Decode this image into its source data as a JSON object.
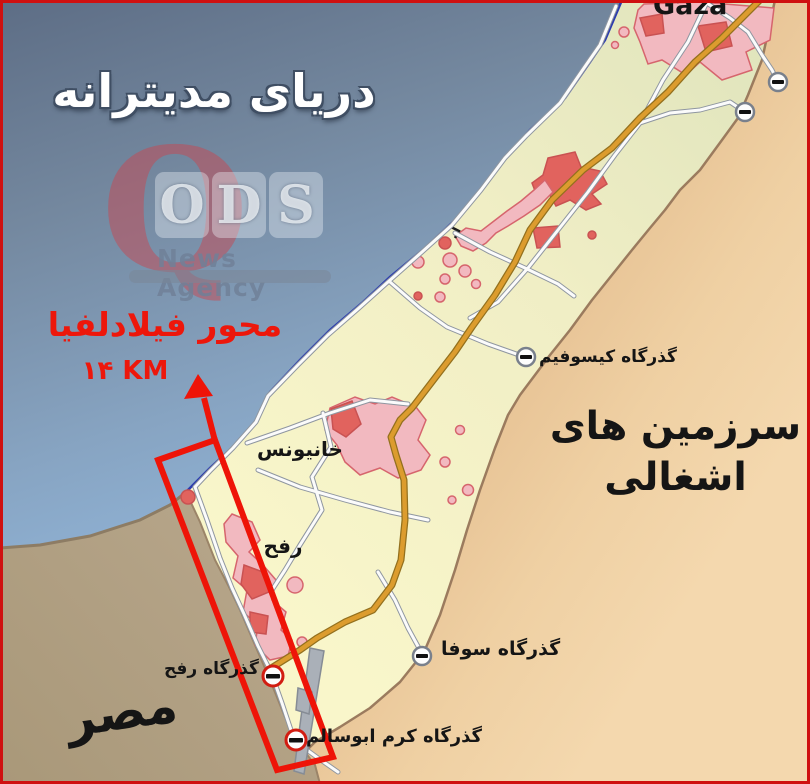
{
  "map_title": "دریای مدیترانه",
  "watermark": {
    "q": "Q",
    "letters": [
      "O",
      "D",
      "S"
    ],
    "tagline": "News Agency"
  },
  "annotation": {
    "corridor_title": "محور فیلادلفیا",
    "corridor_length": "۱۴ KM"
  },
  "places": {
    "gaza_city": "Gaza",
    "khan_younis": "خانیونس",
    "rafah": "رفح",
    "egypt": "مصر",
    "occupied_line1": "سرزمین های",
    "occupied_line2": "اشغالی"
  },
  "crossings": {
    "kissufim": "گذرگاه کیسوفیم",
    "sufa": "گذرگاه سوفا",
    "rafah": "گذرگاه رفح",
    "kerem_abu_salem": "گذرگاه کرم ابوسالم"
  },
  "colors": {
    "sea_top": "#5d6d85",
    "sea_bottom": "#a6cdf2",
    "gaza_north": "#dfe4bc",
    "gaza_south": "#f9f6ca",
    "israel": "#efd0a3",
    "egypt": "#b3a288",
    "urban_pink": "#f2b9c0",
    "urban_red": "#e1635e",
    "road_main": "#dc9c2e",
    "road_minor": "#fbfbfb",
    "coastline": "#2c3cae",
    "border_brown": "#9b7b5e",
    "annotation_red": "#ee1408",
    "frame_red": "#cf1010"
  }
}
